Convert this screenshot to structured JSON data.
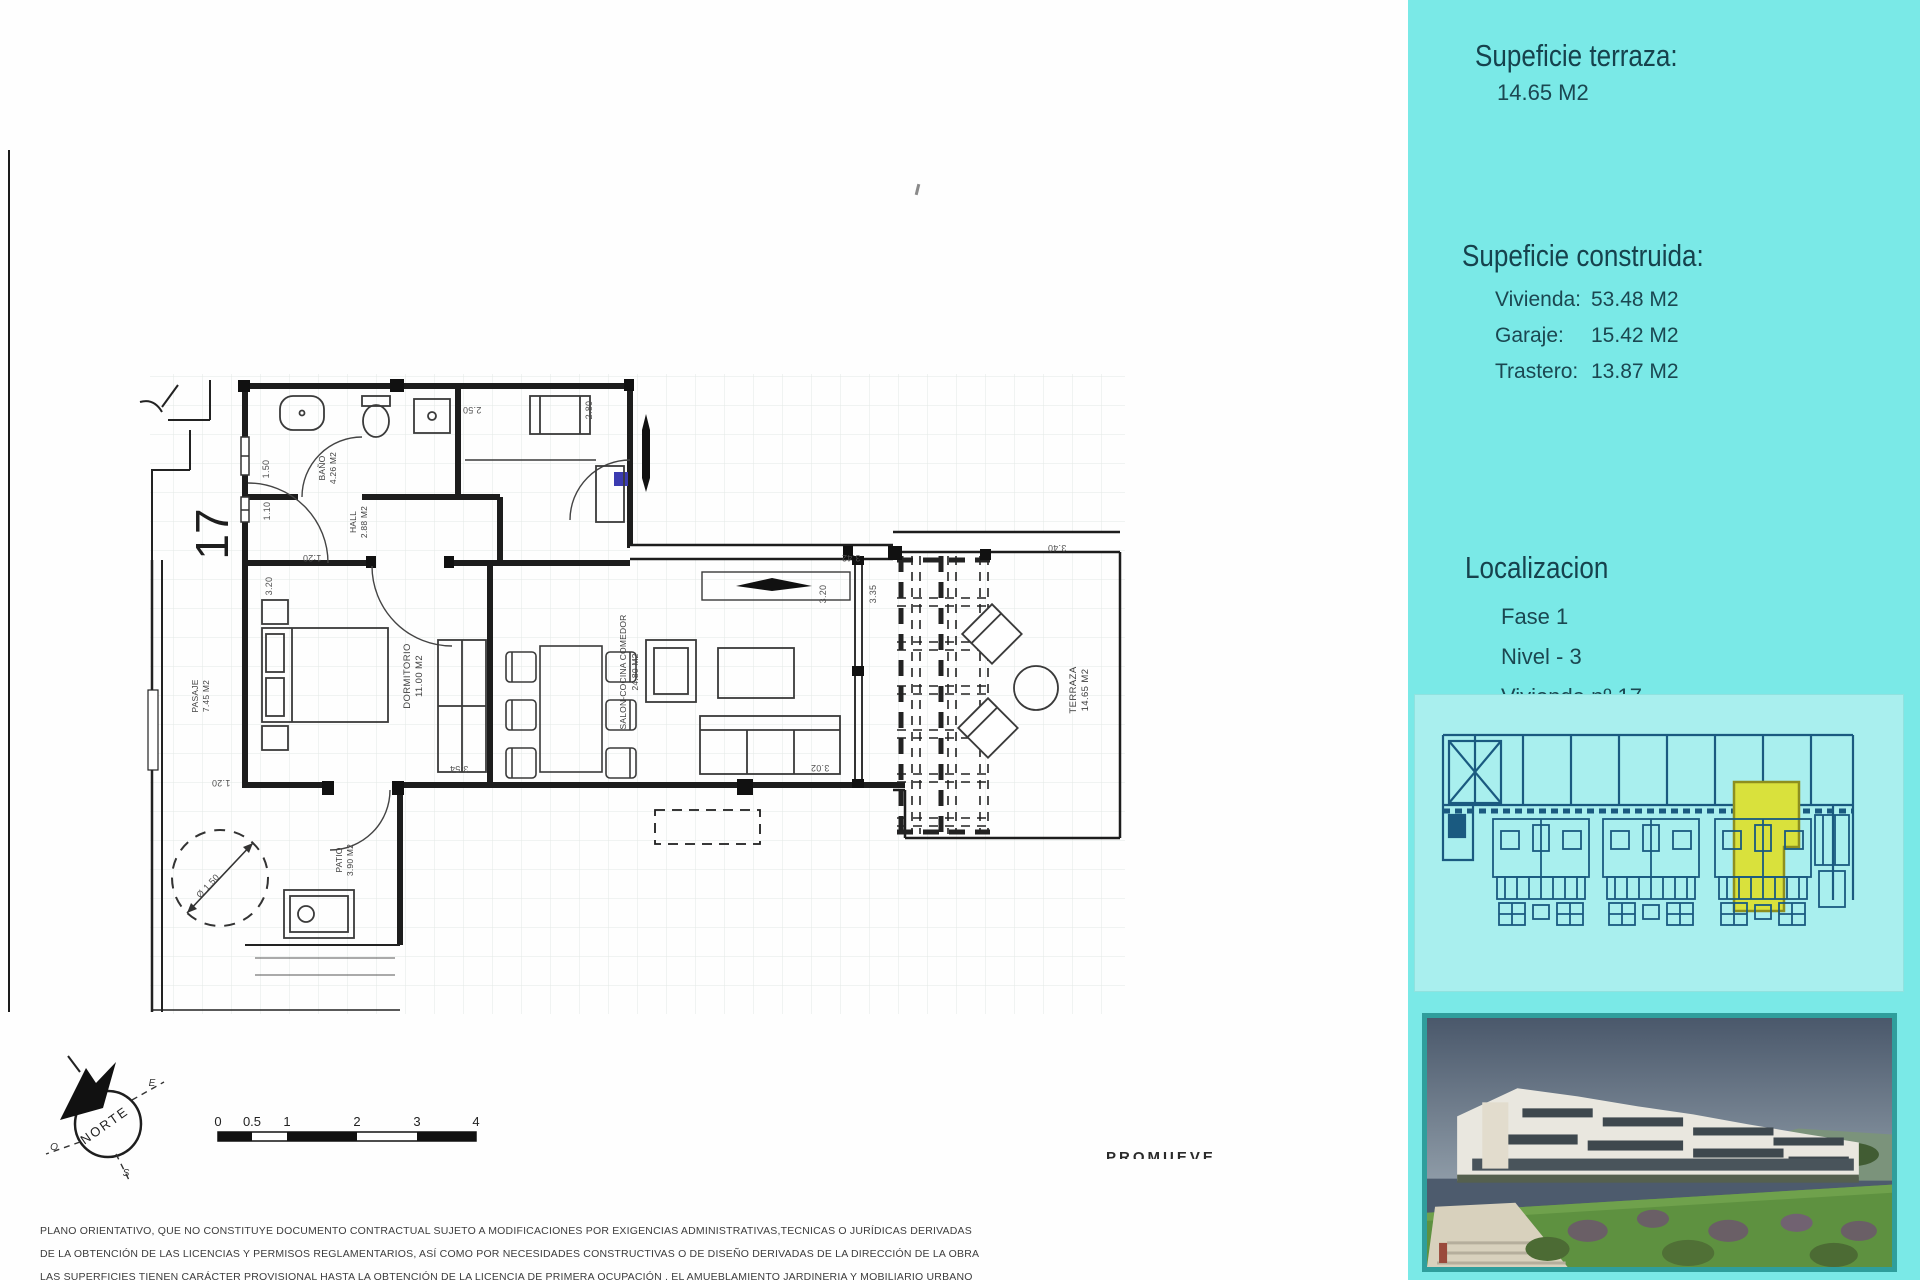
{
  "colors": {
    "sidebar_cyan": "#7ae9e7",
    "siteplan_bg": "#a9efee",
    "siteplan_line_blue": "#1a5a80",
    "highlight_yellow": "#d9e13c",
    "photo_frame_teal": "#2f9e9c"
  },
  "sidebar": {
    "terrace": {
      "heading": "Supeficie terraza:",
      "value": "14.65 M2"
    },
    "built": {
      "heading": "Supeficie construida:",
      "rows": [
        {
          "label": "Vivienda:",
          "value": "53.48 M2"
        },
        {
          "label": "Garaje:",
          "value": "15.42 M2"
        },
        {
          "label": "Trastero:",
          "value": "13.87 M2"
        }
      ]
    },
    "location": {
      "heading": "Localizacion",
      "items": [
        "Fase 1",
        "Nivel - 3",
        "Vivienda nº.17"
      ]
    }
  },
  "plan": {
    "unit_number": "17",
    "rooms": {
      "bano": {
        "name": "BAÑO",
        "area": "4.26 M2"
      },
      "hall": {
        "name": "HALL",
        "area": "2.88 M2"
      },
      "pasaje": {
        "name": "PASAJE",
        "area": "7.45 M2"
      },
      "dormitorio": {
        "name": "DORMITORIO",
        "area": "11.00 M2"
      },
      "salon": {
        "name": "SALON-COCINA COMEDOR",
        "area": "24.80 M2"
      },
      "terraza": {
        "name": "TERRAZA",
        "area": "14.65 M2"
      },
      "patio": {
        "name": "PATIO",
        "area": "3.90 M2"
      }
    },
    "dims": {
      "d250": "2.50",
      "d280": "2.80",
      "d342": "3.42",
      "d320a": "3.20",
      "d320b": "3.20",
      "d335": "3.35",
      "d340": "3.40",
      "d302": "3.02",
      "d354": "3.54",
      "d150": "1.50",
      "d110": "1.10",
      "d120a": "1:20",
      "d120b": "1.20",
      "diameter": "Ø 1.50"
    },
    "compass": {
      "north": "NORTE",
      "east": "E",
      "west": "O",
      "south": "S"
    },
    "scale": {
      "ticks": [
        "0",
        "0.5",
        "1",
        "2",
        "3",
        "4"
      ]
    }
  },
  "footer": {
    "promoter_label": "PROMUEVE",
    "disclaimer_lines": [
      "PLANO ORIENTATIVO, QUE NO CONSTITUYE DOCUMENTO CONTRACTUAL SUJETO A MODIFICACIONES POR EXIGENCIAS ADMINISTRATIVAS,TECNICAS O JURÍDICAS DERIVADAS",
      "DE LA OBTENCIÓN DE LAS LICENCIAS Y PERMISOS REGLAMENTARIOS, ASÍ COMO POR NECESIDADES CONSTRUCTIVAS  O DE DISEÑO DERIVADAS DE LA DIRECCIÓN DE LA OBRA",
      "LAS SUPERFICIES TIENEN CARÁCTER PROVISIONAL HASTA LA OBTENCIÓN DE LA LICENCIA DE PRIMERA OCUPACIÓN , EL AMUEBLAMIENTO JARDINERIA Y MOBILIARIO URBANO"
    ]
  }
}
